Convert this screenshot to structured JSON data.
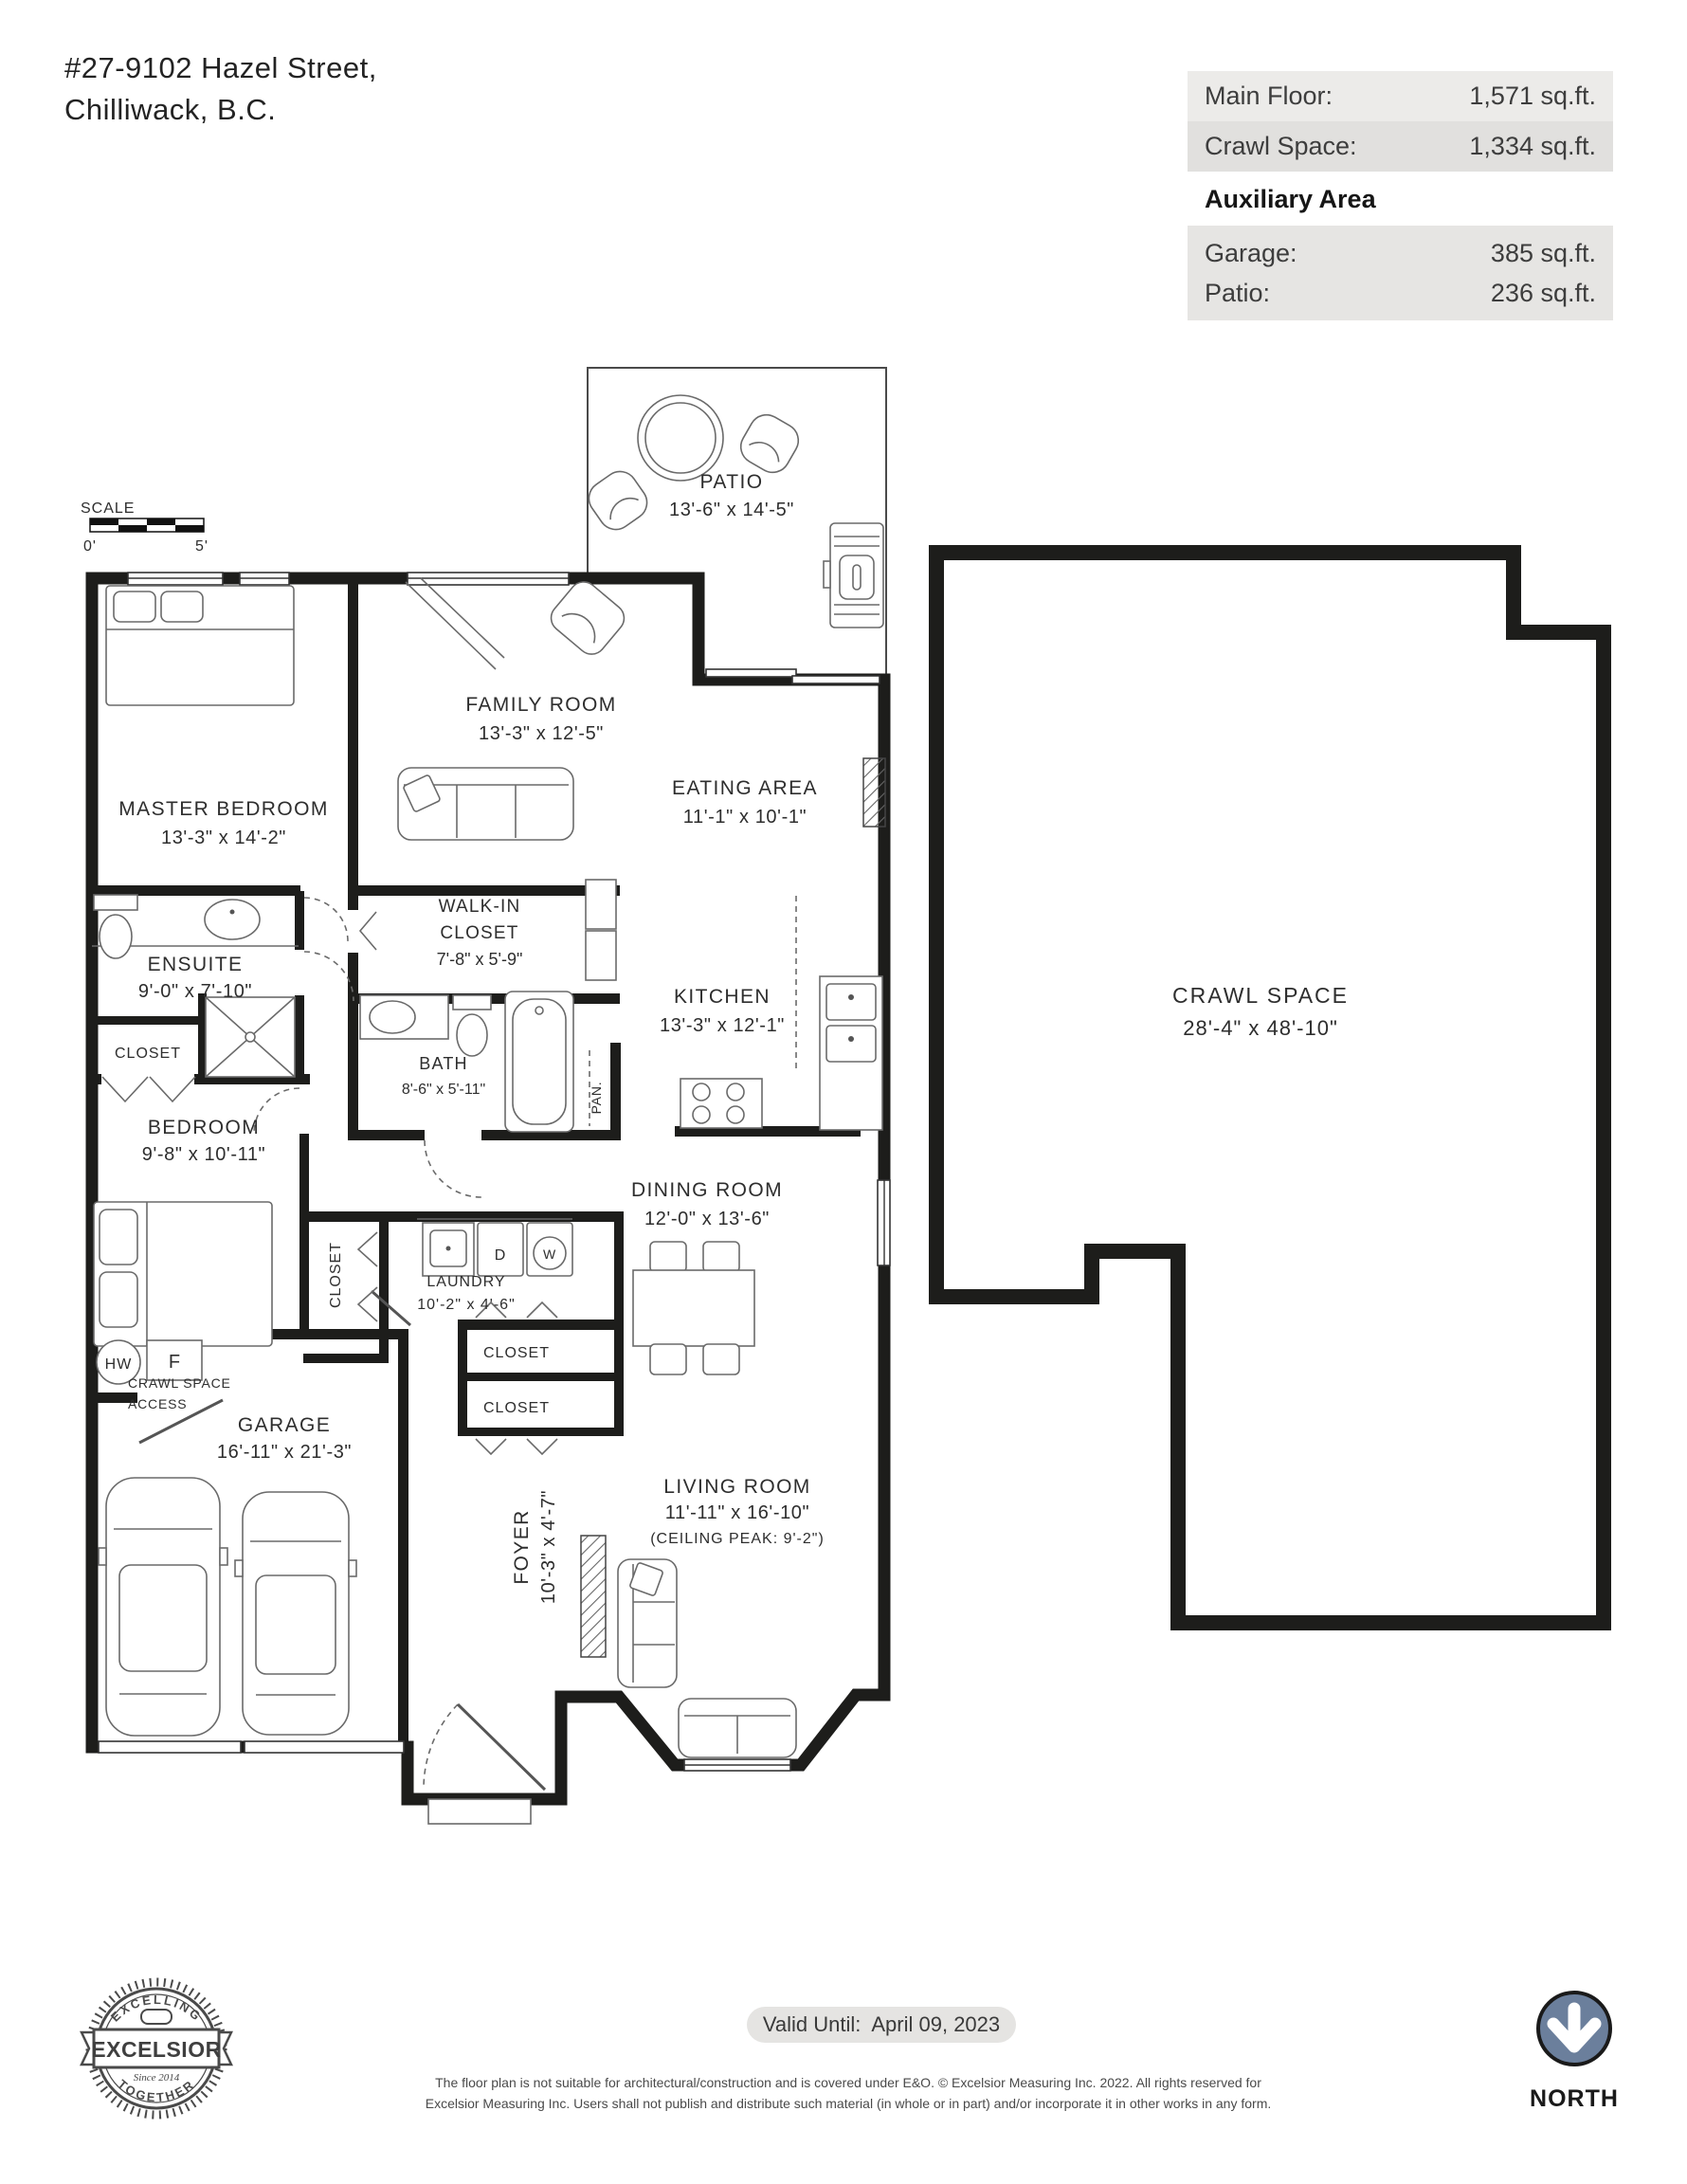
{
  "header": {
    "address_line1": "#27-9102 Hazel Street,",
    "address_line2": "Chilliwack, B.C.",
    "area_rows": [
      {
        "label": "Main Floor:",
        "value": "1,571 sq.ft."
      },
      {
        "label": "Crawl Space:",
        "value": "1,334 sq.ft."
      }
    ],
    "auxiliary_title": "Auxiliary Area",
    "auxiliary_rows": [
      {
        "label": "Garage:",
        "value": "385 sq.ft."
      },
      {
        "label": "Patio:",
        "value": "236 sq.ft."
      }
    ]
  },
  "scale_bar": {
    "title": "SCALE",
    "start_label": "0'",
    "end_label": "5'"
  },
  "rooms": {
    "patio": {
      "name": "PATIO",
      "dims": "13'-6\" x 14'-5\""
    },
    "family_room": {
      "name": "FAMILY ROOM",
      "dims": "13'-3\" x 12'-5\""
    },
    "master_bedroom": {
      "name": "MASTER BEDROOM",
      "dims": "13'-3\" x 14'-2\""
    },
    "eating_area": {
      "name": "EATING AREA",
      "dims": "11'-1\" x 10'-1\""
    },
    "walk_in_closet": {
      "name_line1": "WALK-IN",
      "name_line2": "CLOSET",
      "dims": "7'-8\" x 5'-9\""
    },
    "ensuite": {
      "name": "ENSUITE",
      "dims": "9'-0\" x 7'-10\""
    },
    "kitchen": {
      "name": "KITCHEN",
      "dims": "13'-3\" x 12'-1\""
    },
    "bath": {
      "name": "BATH",
      "dims": "8'-6\" x 5'-11\""
    },
    "bedroom": {
      "name": "BEDROOM",
      "dims": "9'-8\" x 10'-11\""
    },
    "dining_room": {
      "name": "DINING ROOM",
      "dims": "12'-0\" x 13'-6\""
    },
    "laundry": {
      "name": "LAUNDRY",
      "dims": "10'-2\" x 4'-6\""
    },
    "garage": {
      "name": "GARAGE",
      "dims": "16'-11\" x 21'-3\""
    },
    "foyer": {
      "name": "FOYER",
      "dims": "10'-3\" x 4'-7\""
    },
    "living_room": {
      "name": "LIVING ROOM",
      "dims": "11'-11\" x 16'-10\"",
      "note": "(CEILING PEAK: 9'-2\")"
    },
    "crawl_space": {
      "name": "CRAWL SPACE",
      "dims": "28'-4\" x 48'-10\""
    }
  },
  "small_labels": {
    "closet_master": "CLOSET",
    "closet_bedroom": "CLOSET",
    "closet_hall_1": "CLOSET",
    "closet_hall_2": "CLOSET",
    "pantry": "PAN.",
    "crawl_access_line1": "CRAWL SPACE",
    "crawl_access_line2": "ACCESS",
    "hot_water": "HW",
    "furnace": "F",
    "dryer": "D",
    "washer": "W"
  },
  "footer": {
    "valid_until": "Valid Until:  April 09, 2023",
    "disclaimer_line1": "The floor plan is not suitable for architectural/construction and is covered under E&O. © Excelsior Measuring Inc. 2022. All rights reserved for",
    "disclaimer_line2": "Excelsior Measuring Inc. Users shall not publish and distribute such material (in whole or in part) and/or incorporate it in other works in any form.",
    "north_label": "NORTH",
    "logo": {
      "arc_top": "EXCELLING",
      "name": "EXCELSIOR",
      "since": "Since 2014",
      "arc_bottom": "TOGETHER"
    }
  },
  "colors": {
    "wall": "#1d1d1b",
    "north_circle": "#6b7f9c",
    "row_bg_light": "#ecebe9",
    "row_bg_dark": "#e1e0de",
    "aux_bg": "#e6e5e3",
    "pill_bg": "#e5e4e2"
  }
}
